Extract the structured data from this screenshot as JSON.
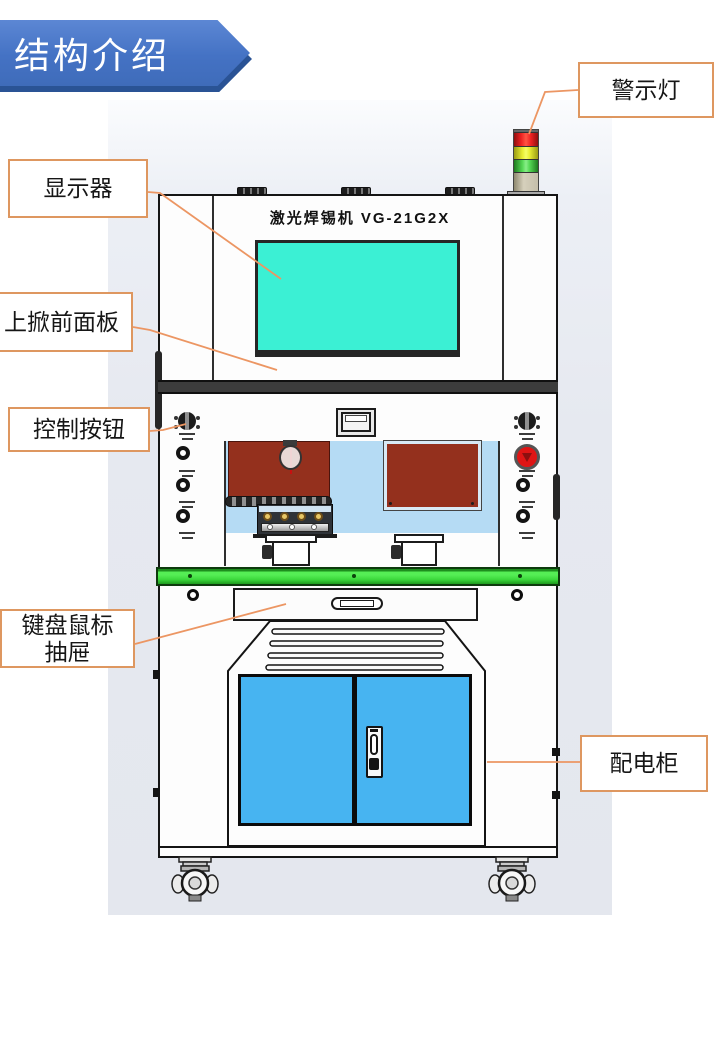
{
  "slide": {
    "title": "结构介绍"
  },
  "machine": {
    "model_text": "激光焊锡机 VG-21G2X",
    "colors": {
      "banner_blue": "#4472c4",
      "banner_shadow_blue": "#2a5395",
      "callout_border_orange": "#de9760",
      "leader_line_orange": "#ec9663",
      "screen_cyan": "#3bf0d4",
      "door_blue": "#47b4f1",
      "table_green": "#3edc3e",
      "panel_brown": "#94301d",
      "lamp_red": "#de1212",
      "lamp_yellow": "#e2e834",
      "lamp_green": "#56d856",
      "lamp_base_tan": "#cbc5b2",
      "backdrop_gray": "#e7eaf1"
    }
  },
  "callouts": [
    {
      "id": "warning-light",
      "label": "警示灯"
    },
    {
      "id": "monitor",
      "label": "显示器"
    },
    {
      "id": "flip-up-front-panel",
      "label": "上掀前面板"
    },
    {
      "id": "control-buttons",
      "label": "控制按钮"
    },
    {
      "id": "keyboard-mouse-drawer",
      "lines": [
        "键盘鼠标",
        "抽屉"
      ]
    },
    {
      "id": "power-distribution-cabinet",
      "label": "配电柜"
    }
  ]
}
